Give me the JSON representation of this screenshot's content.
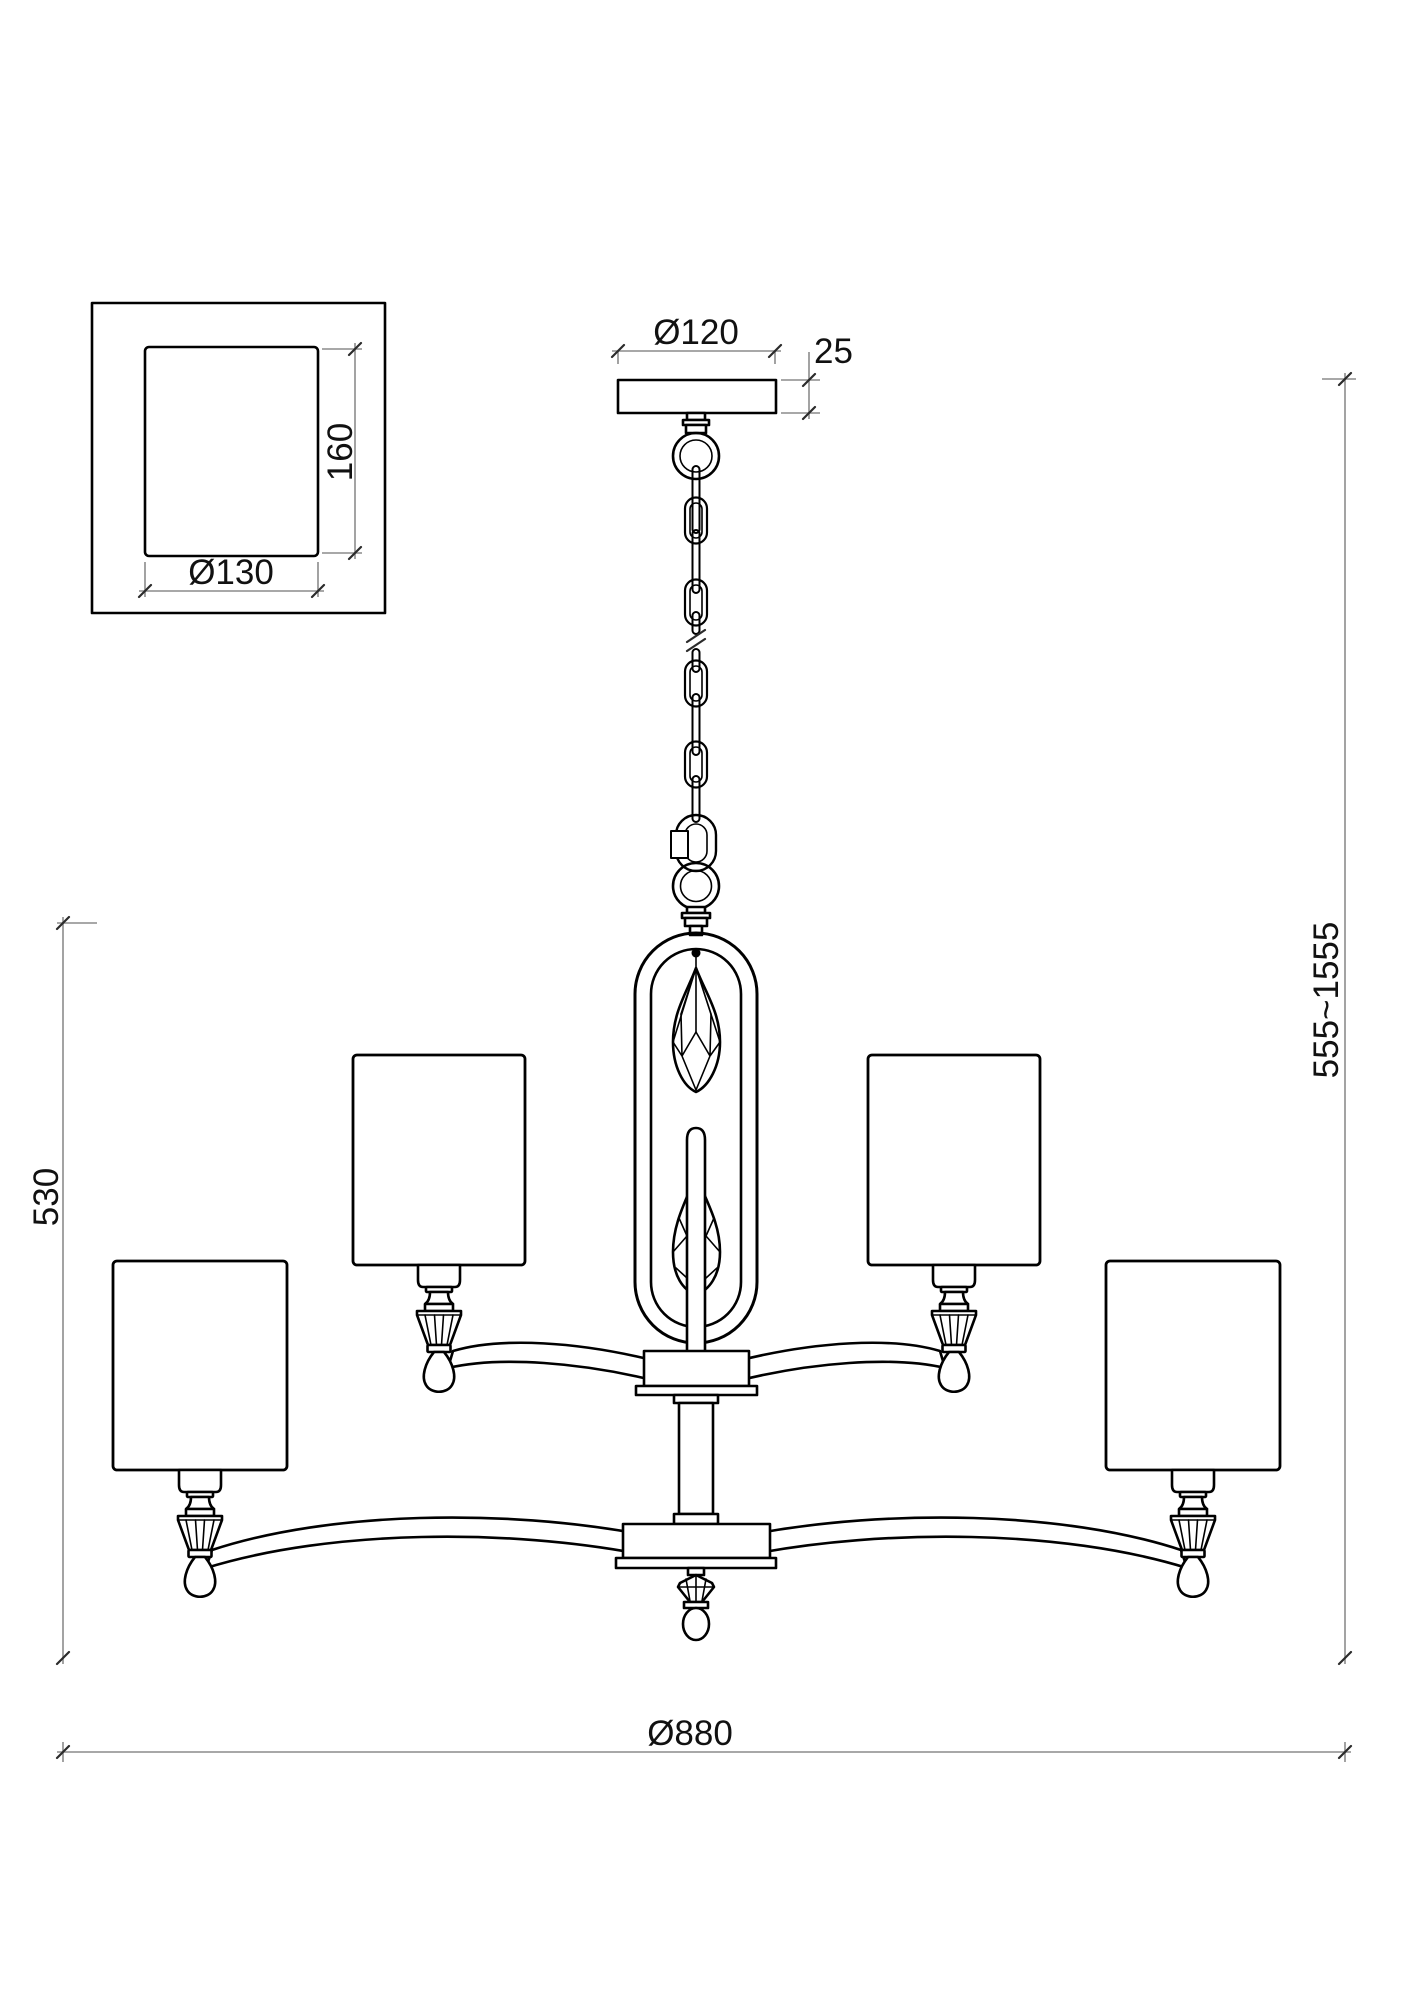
{
  "drawing": {
    "detail_view": {
      "height_label": "160",
      "diameter_label": "Ø130"
    },
    "canopy": {
      "diameter_label": "Ø120",
      "height_label": "25"
    },
    "dimensions": {
      "body_height": "530",
      "overall_height": "555~1555",
      "overall_diameter": "Ø880"
    },
    "colors": {
      "outline": "#000000",
      "dimension_line": "#8c8c8c",
      "text": "#111111",
      "background": "#ffffff"
    }
  }
}
